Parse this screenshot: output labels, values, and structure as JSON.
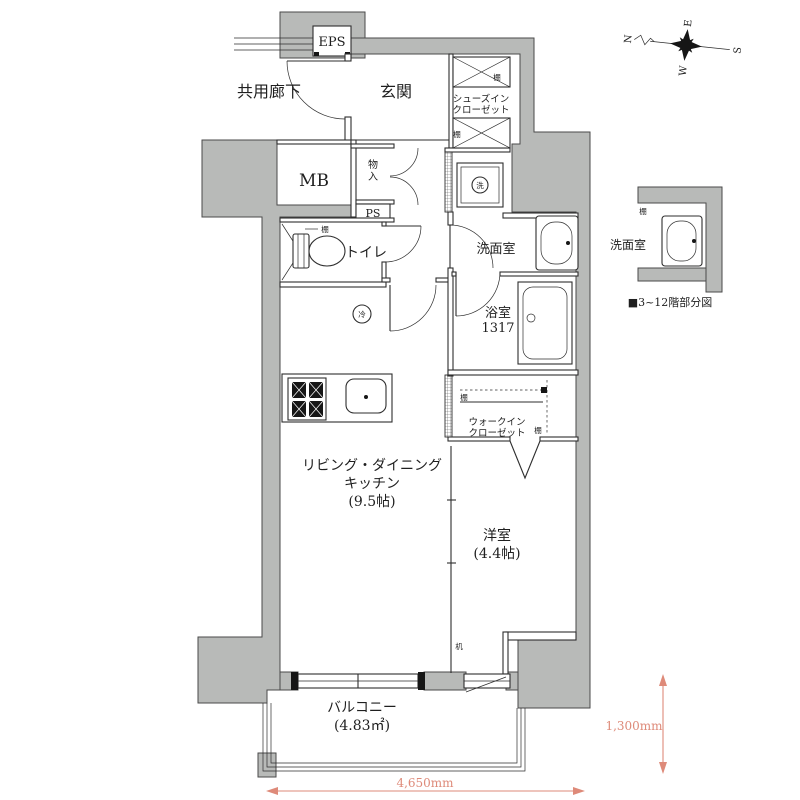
{
  "colors": {
    "wall": "#b8bab8",
    "line": "#2e2e2e",
    "dimension": "#de8a79",
    "text": "#1f1f1f"
  },
  "labels": {
    "eps": "EPS",
    "corridor": "共用廊下",
    "entrance": "玄関",
    "shoes1": "シューズイン",
    "shoes2": "クローゼット",
    "mb": "MB",
    "storage1": "物",
    "storage2": "入",
    "ps": "PS",
    "toilet": "トイレ",
    "washroom": "洗面室",
    "bathroom": "浴室",
    "bathroom_size": "1317",
    "wic1": "ウォークイン",
    "wic2": "クローゼット",
    "ldk1": "リビング・ダイニング",
    "ldk2": "キッチン",
    "ldk3": "(9.5帖)",
    "western": "洋室",
    "western_size": "(4.4帖)",
    "balcony": "バルコニー",
    "balcony_size": "(4.83㎡)",
    "washer": "洗",
    "fridge": "冷",
    "shelf": "棚",
    "desk": "机"
  },
  "partial": {
    "washroom": "洗面室",
    "caption": "■3~12階部分図"
  },
  "dimensions": {
    "width": "4,650mm",
    "height": "1,300mm"
  },
  "compass": {
    "n": "N",
    "e": "E",
    "s": "S",
    "w": "W"
  }
}
